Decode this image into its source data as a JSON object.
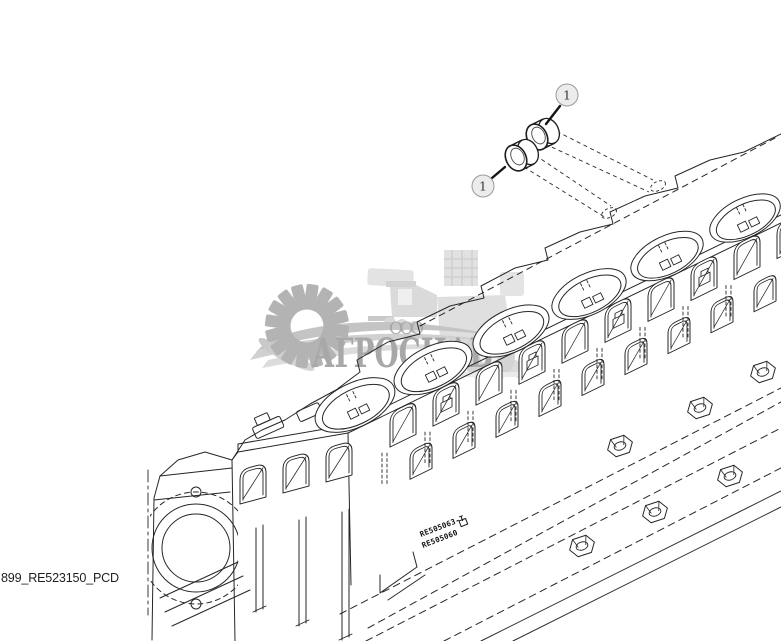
{
  "diagram": {
    "footer_code": "899_RE523150_PCD",
    "callouts": [
      {
        "label": "1"
      },
      {
        "label": "1"
      }
    ],
    "cast_marks": {
      "line1": "RE505063-T",
      "line2": "RE505060"
    },
    "line_color": "#262626",
    "callout_fill": "#ececec",
    "callout_stroke": "#9a9a9a"
  },
  "watermark": {
    "org_form": "ООО",
    "name": "АГРОСНАБ",
    "text_color": "#a8a8a8",
    "gear_color": "#b3b3b3",
    "machine_color": "#e0e0e0"
  }
}
